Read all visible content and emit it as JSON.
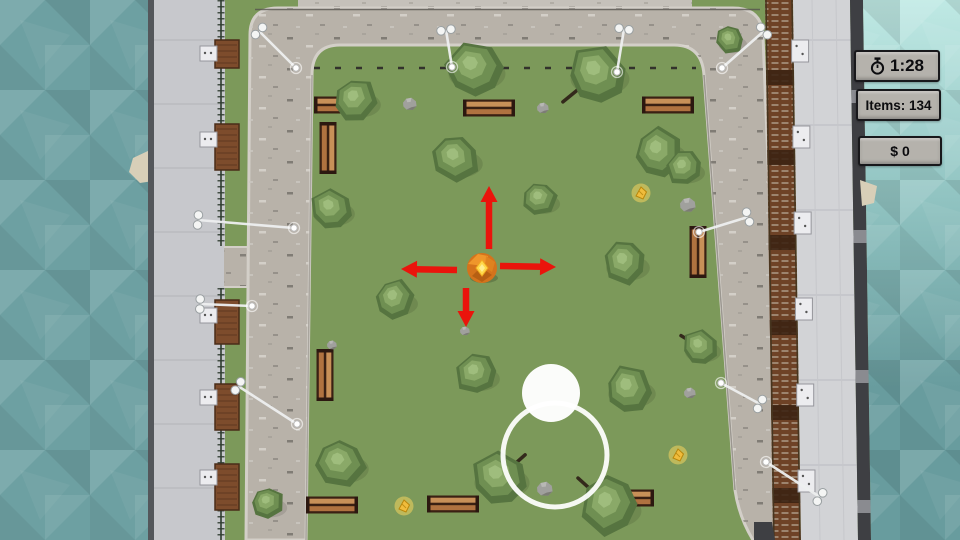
{
  "hud": {
    "timer": {
      "value": "1:28",
      "icon": "stopwatch-icon"
    },
    "items": {
      "text": "Items: 134"
    },
    "money": {
      "text": "$ 0"
    }
  },
  "scene": {
    "colors": {
      "grass": "#7c995a",
      "road": "#b8b2a9",
      "curb": "#d3cfc8",
      "roadEdge": "#8e8a83",
      "sidewalk": "#c5c1ba",
      "waterLeft": "#6da0a2",
      "waterRightTop": "#bfe9e4",
      "waterRightMid": "#8fc2c0",
      "waterRightBottom": "#689c9e",
      "quay": "#c7c8cc",
      "quaySeam": "#b3b4b9",
      "quayEdge": "#54575b",
      "fence": "#2e3b2f",
      "crate": "#7d4c2c",
      "crateLine": "#4a2c18",
      "ac": "#ececef",
      "acEdge": "#96969c",
      "fireEscape": "#6e4226",
      "fireEscapeDark": "#3c2413",
      "fireEscapeRail": "#46351f",
      "rooftop": "#d2d3d6",
      "roofSeam": "#bfc0c5",
      "edgeDark": "#3e3f43",
      "tree1": "#567440",
      "tree2": "#6f8f52",
      "tree3": "#8aa968",
      "tree4": "#9fbd7d",
      "branch": "#33291b",
      "rock": "#a0a09d",
      "rockDark": "#76766f",
      "rockLight": "#c2c2bf",
      "benchDark": "#3a2013",
      "benchSlat1": "#c89058",
      "benchSlat2": "#b07240",
      "arrow": "#ea140c",
      "ballBase": "#d4731c",
      "ballLight": "#f29a2e",
      "ballDark": "#b05c12",
      "gem": "#ffd84a",
      "item": "#f0bc3c",
      "itemEdge": "#b8860b",
      "itemGlow": "#ffd95e",
      "lamp": "#eef0f0",
      "white": "#ffffff",
      "panelBg": "#b5b2ac",
      "panelBorder": "#18181b",
      "panelText": "#0c0c0f",
      "sand": "#d8cfb8"
    },
    "trees": [
      {
        "x": 474,
        "y": 69,
        "s": 30,
        "r": 0
      },
      {
        "x": 597,
        "y": 74,
        "s": 31,
        "r": 40,
        "b": [
          -1.1,
          0.9
        ]
      },
      {
        "x": 356,
        "y": 100,
        "s": 23,
        "r": 120
      },
      {
        "x": 456,
        "y": 159,
        "s": 25,
        "r": 200
      },
      {
        "x": 659,
        "y": 152,
        "s": 26,
        "r": 80
      },
      {
        "x": 684,
        "y": 168,
        "s": 19,
        "r": 300
      },
      {
        "x": 540,
        "y": 199,
        "s": 18,
        "r": 160
      },
      {
        "x": 331,
        "y": 209,
        "s": 22,
        "r": 20
      },
      {
        "x": 625,
        "y": 263,
        "s": 23,
        "r": 250
      },
      {
        "x": 395,
        "y": 299,
        "s": 21,
        "r": 100
      },
      {
        "x": 476,
        "y": 374,
        "s": 22,
        "r": 310
      },
      {
        "x": 629,
        "y": 389,
        "s": 25,
        "r": 60
      },
      {
        "x": 341,
        "y": 464,
        "s": 26,
        "r": 180
      },
      {
        "x": 499,
        "y": 478,
        "s": 29,
        "r": 20,
        "b": [
          0.9,
          -0.8
        ]
      },
      {
        "x": 609,
        "y": 506,
        "s": 31,
        "r": 270,
        "b": [
          -1.0,
          -0.9
        ]
      },
      {
        "x": 268,
        "y": 503,
        "s": 17,
        "r": 140
      },
      {
        "x": 730,
        "y": 40,
        "s": 15,
        "r": 220
      },
      {
        "x": 700,
        "y": 347,
        "s": 19,
        "r": 30,
        "b": [
          -1.0,
          -0.6
        ]
      }
    ],
    "rocks": [
      {
        "x": 410,
        "y": 104,
        "s": 7
      },
      {
        "x": 543,
        "y": 108,
        "s": 6
      },
      {
        "x": 688,
        "y": 205,
        "s": 8
      },
      {
        "x": 465,
        "y": 331,
        "s": 5
      },
      {
        "x": 332,
        "y": 345,
        "s": 5
      },
      {
        "x": 690,
        "y": 393,
        "s": 6
      },
      {
        "x": 545,
        "y": 489,
        "s": 8
      }
    ],
    "benches": [
      {
        "x": 340,
        "y": 105,
        "o": "h"
      },
      {
        "x": 489,
        "y": 108,
        "o": "h"
      },
      {
        "x": 668,
        "y": 105,
        "o": "h"
      },
      {
        "x": 328,
        "y": 148,
        "o": "v"
      },
      {
        "x": 325,
        "y": 375,
        "o": "v"
      },
      {
        "x": 698,
        "y": 252,
        "o": "v"
      },
      {
        "x": 332,
        "y": 505,
        "o": "h"
      },
      {
        "x": 453,
        "y": 504,
        "o": "h"
      },
      {
        "x": 628,
        "y": 498,
        "o": "h"
      }
    ],
    "lamps": [
      {
        "bx": 446,
        "by": 30,
        "ex": 452,
        "ey": 67
      },
      {
        "bx": 624,
        "by": 29,
        "ex": 617,
        "ey": 72
      },
      {
        "bx": 259,
        "by": 31,
        "ex": 296,
        "ey": 68
      },
      {
        "bx": 764,
        "by": 31,
        "ex": 722,
        "ey": 68
      },
      {
        "bx": 198,
        "by": 220,
        "ex": 294,
        "ey": 228
      },
      {
        "bx": 200,
        "by": 304,
        "ex": 252,
        "ey": 306
      },
      {
        "bx": 238,
        "by": 386,
        "ex": 297,
        "ey": 424
      },
      {
        "bx": 748,
        "by": 217,
        "ex": 699,
        "ey": 232
      },
      {
        "bx": 760,
        "by": 404,
        "ex": 721,
        "ey": 383
      },
      {
        "bx": 820,
        "by": 497,
        "ex": 766,
        "ey": 462
      }
    ],
    "items": [
      {
        "x": 641,
        "y": 193
      },
      {
        "x": 404,
        "y": 506
      },
      {
        "x": 678,
        "y": 455
      }
    ],
    "crates": [
      {
        "y": 40,
        "h": 28
      },
      {
        "y": 124,
        "h": 46
      },
      {
        "y": 300,
        "h": 44
      },
      {
        "y": 384,
        "h": 46
      },
      {
        "y": 464,
        "h": 46
      }
    ],
    "acLeft": [
      46,
      132,
      308,
      390,
      470
    ],
    "acRight": [
      40,
      126,
      212,
      298,
      384,
      470
    ],
    "player": {
      "x": 482,
      "y": 268,
      "r": 15
    },
    "arrows": [
      {
        "x1": 489,
        "y1": 249,
        "x2": 489,
        "y2": 186
      },
      {
        "x1": 466,
        "y1": 288,
        "x2": 466,
        "y2": 327
      },
      {
        "x1": 457,
        "y1": 270,
        "x2": 401,
        "y2": 269
      },
      {
        "x1": 500,
        "y1": 266,
        "x2": 556,
        "y2": 267
      }
    ],
    "joystick": {
      "ring": {
        "x": 555,
        "y": 455,
        "r": 52
      },
      "knob": {
        "x": 551,
        "y": 393,
        "r": 29
      }
    }
  }
}
